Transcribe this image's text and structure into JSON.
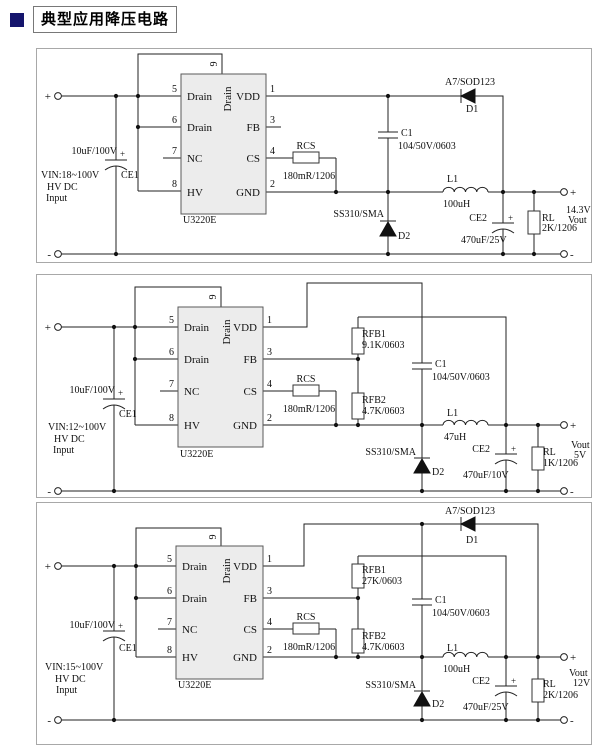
{
  "title": {
    "text": "典型应用降压电路"
  },
  "circuits": [
    {
      "vin": [
        "VIN:18~100V",
        "HV DC",
        "Input"
      ],
      "in_plus": "+",
      "in_minus": "-",
      "out_plus": "+",
      "out_minus": "-",
      "ce1": {
        "ref": "CE1",
        "value": "10uF/100V",
        "polarity": "+"
      },
      "ic": {
        "part": "U3220E",
        "left_pins": [
          {
            "num": "5",
            "name": "Drain"
          },
          {
            "num": "6",
            "name": "Drain"
          },
          {
            "num": "7",
            "name": "NC"
          },
          {
            "num": "8",
            "name": "HV"
          }
        ],
        "right_pins": [
          {
            "num": "1",
            "name": "VDD"
          },
          {
            "num": "3",
            "name": "FB"
          },
          {
            "num": "4",
            "name": "CS"
          },
          {
            "num": "2",
            "name": "GND"
          }
        ],
        "top_pin": {
          "num": "9",
          "name": "Drain"
        }
      },
      "rcs": {
        "ref": "RCS",
        "value": "180mR/1206"
      },
      "c1": {
        "ref": "C1",
        "value": "104/50V/0603"
      },
      "d1": {
        "ref": "D1",
        "part": "A7/SOD123"
      },
      "d2": {
        "ref": "D2",
        "part": "SS310/SMA"
      },
      "l1": {
        "ref": "L1",
        "value": "100uH"
      },
      "ce2": {
        "ref": "CE2",
        "value": "470uF/25V",
        "polarity": "+"
      },
      "rl": {
        "ref": "RL",
        "value": "2K/1206"
      },
      "vout": [
        "14.3V",
        "Vout"
      ]
    },
    {
      "vin": [
        "VIN:12~100V",
        "HV DC",
        "Input"
      ],
      "in_plus": "+",
      "in_minus": "-",
      "out_plus": "+",
      "out_minus": "-",
      "ce1": {
        "ref": "CE1",
        "value": "10uF/100V",
        "polarity": "+"
      },
      "ic": {
        "part": "U3220E",
        "left_pins": [
          {
            "num": "5",
            "name": "Drain"
          },
          {
            "num": "6",
            "name": "Drain"
          },
          {
            "num": "7",
            "name": "NC"
          },
          {
            "num": "8",
            "name": "HV"
          }
        ],
        "right_pins": [
          {
            "num": "1",
            "name": "VDD"
          },
          {
            "num": "3",
            "name": "FB"
          },
          {
            "num": "4",
            "name": "CS"
          },
          {
            "num": "2",
            "name": "GND"
          }
        ],
        "top_pin": {
          "num": "9",
          "name": "Drain"
        }
      },
      "rfb1": {
        "ref": "RFB1",
        "value": "9.1K/0603"
      },
      "rfb2": {
        "ref": "RFB2",
        "value": "4.7K/0603"
      },
      "rcs": {
        "ref": "RCS",
        "value": "180mR/1206"
      },
      "c1": {
        "ref": "C1",
        "value": "104/50V/0603"
      },
      "d2": {
        "ref": "D2",
        "part": "SS310/SMA"
      },
      "l1": {
        "ref": "L1",
        "value": "47uH"
      },
      "ce2": {
        "ref": "CE2",
        "value": "470uF/10V",
        "polarity": "+"
      },
      "rl": {
        "ref": "RL",
        "value": "1K/1206"
      },
      "vout": [
        "Vout",
        "5V"
      ]
    },
    {
      "vin": [
        "VIN:15~100V",
        "HV DC",
        "Input"
      ],
      "in_plus": "+",
      "in_minus": "-",
      "out_plus": "+",
      "out_minus": "-",
      "ce1": {
        "ref": "CE1",
        "value": "10uF/100V",
        "polarity": "+"
      },
      "ic": {
        "part": "U3220E",
        "left_pins": [
          {
            "num": "5",
            "name": "Drain"
          },
          {
            "num": "6",
            "name": "Drain"
          },
          {
            "num": "7",
            "name": "NC"
          },
          {
            "num": "8",
            "name": "HV"
          }
        ],
        "right_pins": [
          {
            "num": "1",
            "name": "VDD"
          },
          {
            "num": "3",
            "name": "FB"
          },
          {
            "num": "4",
            "name": "CS"
          },
          {
            "num": "2",
            "name": "GND"
          }
        ],
        "top_pin": {
          "num": "9",
          "name": "Drain"
        }
      },
      "rfb1": {
        "ref": "RFB1",
        "value": "27K/0603"
      },
      "rfb2": {
        "ref": "RFB2",
        "value": "4.7K/0603"
      },
      "rcs": {
        "ref": "RCS",
        "value": "180mR/1206"
      },
      "c1": {
        "ref": "C1",
        "value": "104/50V/0603"
      },
      "d1": {
        "ref": "D1",
        "part": "A7/SOD123"
      },
      "d2": {
        "ref": "D2",
        "part": "SS310/SMA"
      },
      "l1": {
        "ref": "L1",
        "value": "100uH"
      },
      "ce2": {
        "ref": "CE2",
        "value": "470uF/25V",
        "polarity": "+"
      },
      "rl": {
        "ref": "RL",
        "value": "2K/1206"
      },
      "vout": [
        "Vout",
        "12V"
      ]
    }
  ]
}
